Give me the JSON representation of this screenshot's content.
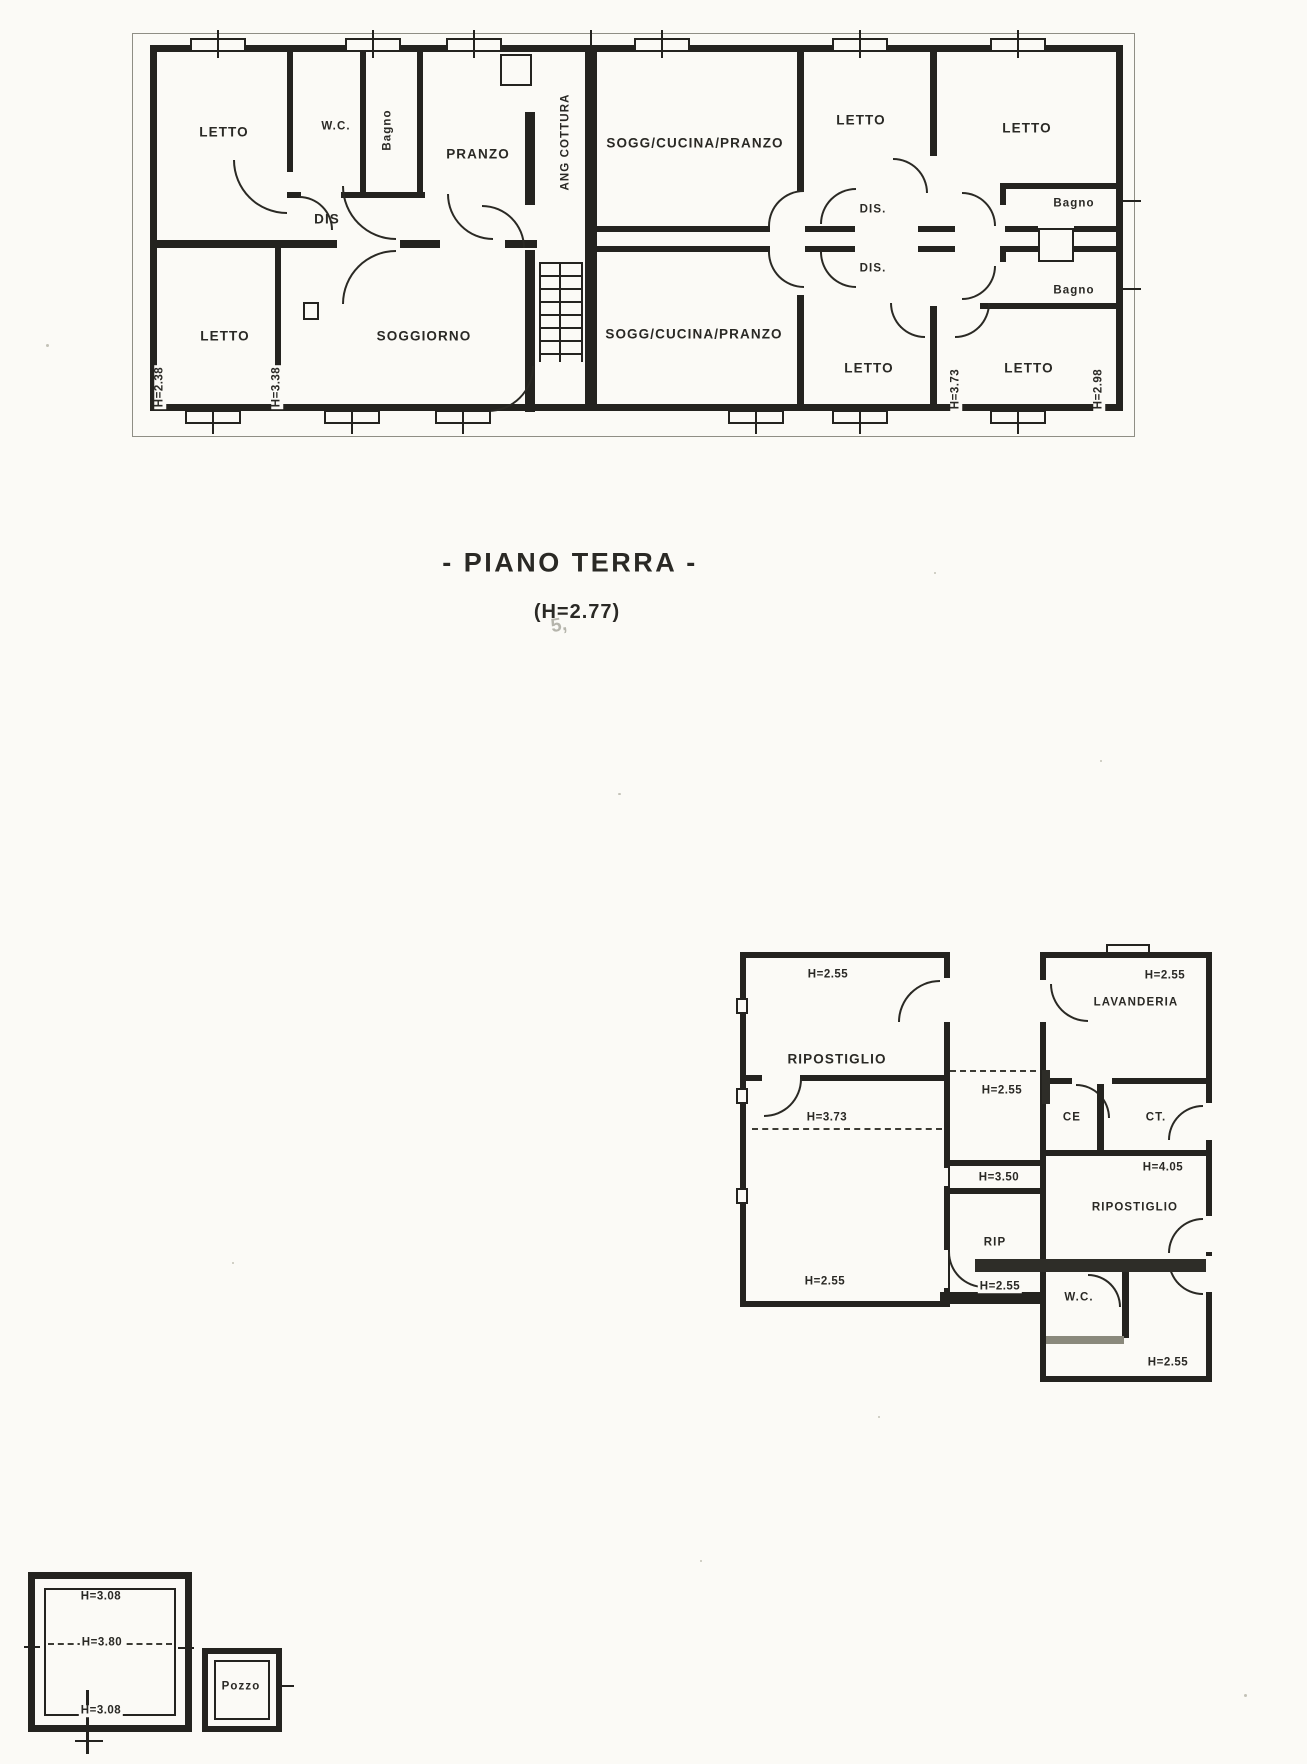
{
  "style": {
    "paper": "#fbfaf6",
    "ink": "#24231f"
  },
  "title": {
    "main": "- PIANO TERRA -",
    "height_note": "(H=2.77)"
  },
  "ground_floor_plan": {
    "left_unit": {
      "letto_nw": "LETTO",
      "wc": "W.C.",
      "bagno": "Bagno",
      "pranzo": "PRANZO",
      "dis": "DIS",
      "letto_sw": "LETTO",
      "soggiorno": "SOGGIORNO",
      "ang_cottura": "ANG COTTURA",
      "h_left_wall": "H=2.38",
      "h_mid_wall": "H=3.38"
    },
    "right_unit_upper": {
      "sogg_cucina_pranzo": "SOGG/CUCINA/PRANZO",
      "letto_a": "LETTO",
      "letto_b": "LETTO",
      "dis": "DIS.",
      "bagno": "Bagno"
    },
    "right_unit_lower": {
      "sogg_cucina_pranzo": "SOGG/CUCINA/PRANZO",
      "letto_a": "LETTO",
      "letto_b": "LETTO",
      "dis": "DIS.",
      "bagno": "Bagno",
      "h_mid_wall": "H=3.73",
      "h_right_wall": "H=2.98"
    }
  },
  "annex_plan": {
    "left_block": {
      "h_top": "H=2.55",
      "ripostiglio": "RIPOSTIGLIO",
      "h_mid": "H=3.73",
      "h_bottom": "H=2.55"
    },
    "middle_block": {
      "h_top": "H=2.55",
      "h_passage": "H=3.50",
      "rip": "RIP",
      "h_bottom": "H=2.55"
    },
    "right_block": {
      "h_top": "H=2.55",
      "lavanderia": "LAVANDERIA",
      "ce": "CE",
      "ct": "CT.",
      "h_ripostiglio": "H=4.05",
      "ripostiglio": "RIPOSTIGLIO",
      "wc": "W.C.",
      "h_bottom": "H=2.55"
    }
  },
  "outbuildings": {
    "square_structure": {
      "h_top": "H=3.08",
      "h_mid": "H=3.80",
      "h_bottom": "H=3.08"
    },
    "well": {
      "label": "Pozzo"
    }
  },
  "artifacts": {
    "smudge": "5,"
  }
}
